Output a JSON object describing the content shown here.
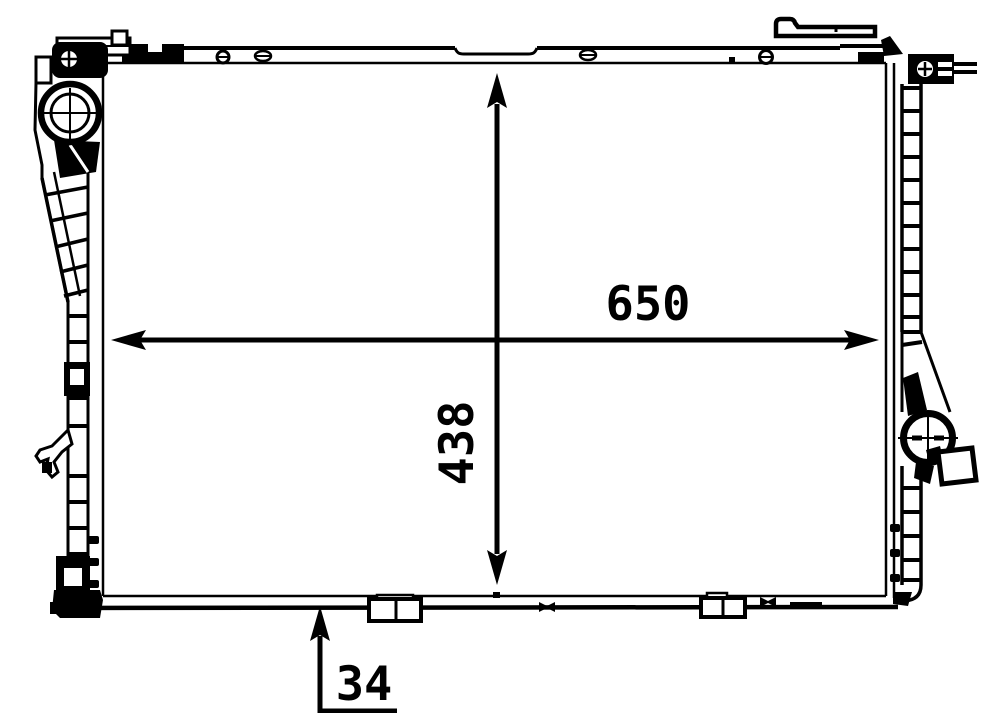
{
  "meta": {
    "description": "Radiator technical line drawing, front view with overall dimension arrows",
    "background_color": "#ffffff",
    "line_color": "#000000"
  },
  "dimensions": {
    "width": {
      "label": "650"
    },
    "height": {
      "label": "438"
    },
    "depth": {
      "label": "34"
    }
  }
}
